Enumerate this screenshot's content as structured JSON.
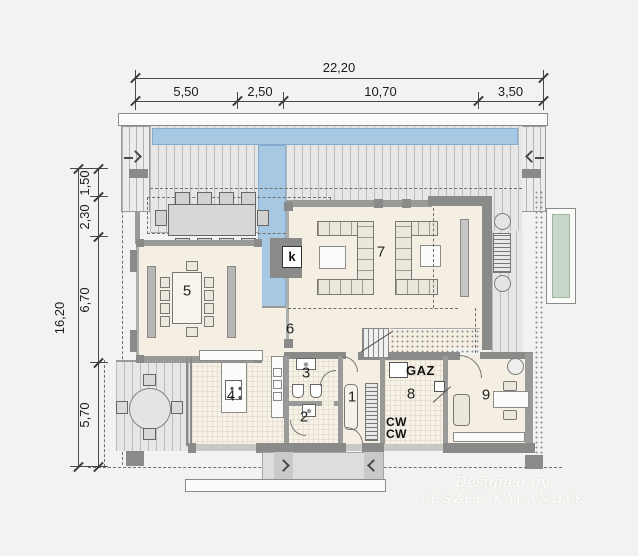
{
  "dims": {
    "top_total": "22,20",
    "top_segments": [
      "5,50",
      "2,50",
      "10,70",
      "3,50"
    ],
    "left_total": "16,20",
    "left_segments": [
      "1,50",
      "2,30",
      "6,70",
      "5,70"
    ]
  },
  "rooms": [
    "1",
    "2",
    "3",
    "4",
    "5",
    "6",
    "7",
    "8",
    "9"
  ],
  "labels": {
    "fireplace": "k",
    "gas": "GAZ",
    "cw1": "CW",
    "cw2": "CW"
  },
  "watermark": {
    "line1": "Designed by",
    "line2": "LESZEK KALANDYK"
  },
  "colors": {
    "water": "#a7c8e2",
    "floor": "#f4eee3",
    "wall": "#9a9a98",
    "wall_dark": "#8a8a88",
    "deck": "#e6e6e4",
    "planter_green": "#c9d7ca"
  }
}
